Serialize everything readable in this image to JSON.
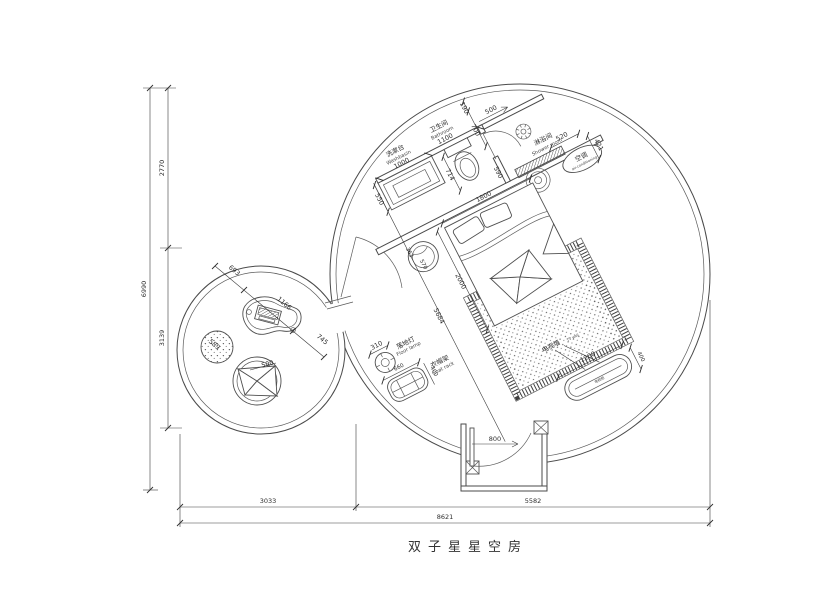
{
  "title": "双子星星空房",
  "colors": {
    "line": "#4a4a4a",
    "background": "#ffffff"
  },
  "labels": {
    "washbasin_zh": "洗漱台",
    "washbasin_en": "Washbasin",
    "bathroom_zh": "卫生间",
    "bathroom_en": "Bathroom",
    "shower_zh": "淋浴间",
    "shower_en": "Shower room",
    "ac_zh": "空调",
    "ac_en": "air-conditioning",
    "lamp_zh": "落地灯",
    "lamp_en": "Floor lamp",
    "rack_zh": "衣帽架",
    "rack_en": "Coat rack",
    "tvwall_zh": "电视墙",
    "tvwall_en": "TV wall",
    "tvcab_zh": "电视柜"
  },
  "dims": {
    "washbasin_w": "1000",
    "washbasin_d": "550",
    "bathroom_w": "1100",
    "wall_a": "190",
    "wall_b": "700",
    "shower_door": "500",
    "wall_c": "590",
    "toilet": "714",
    "bed_w": "1800",
    "bed_l": "2000",
    "diag": "5684",
    "stool_a": "363",
    "stool_b": "570",
    "shower_w": "520",
    "shower_d": "421",
    "lamp": "310",
    "rack_w": "660",
    "rack_d": "400",
    "tv_w": "1200",
    "tv_d": "400",
    "entry": "800",
    "lounge_a": "693",
    "lounge_b": "1166",
    "lounge_c": "745",
    "lounge_stool": "589",
    "lounge_basket": "500",
    "height_total": "6990",
    "height_a": "2770",
    "height_b": "3139",
    "width_a": "3033",
    "width_b": "5582",
    "width_total": "8621"
  }
}
